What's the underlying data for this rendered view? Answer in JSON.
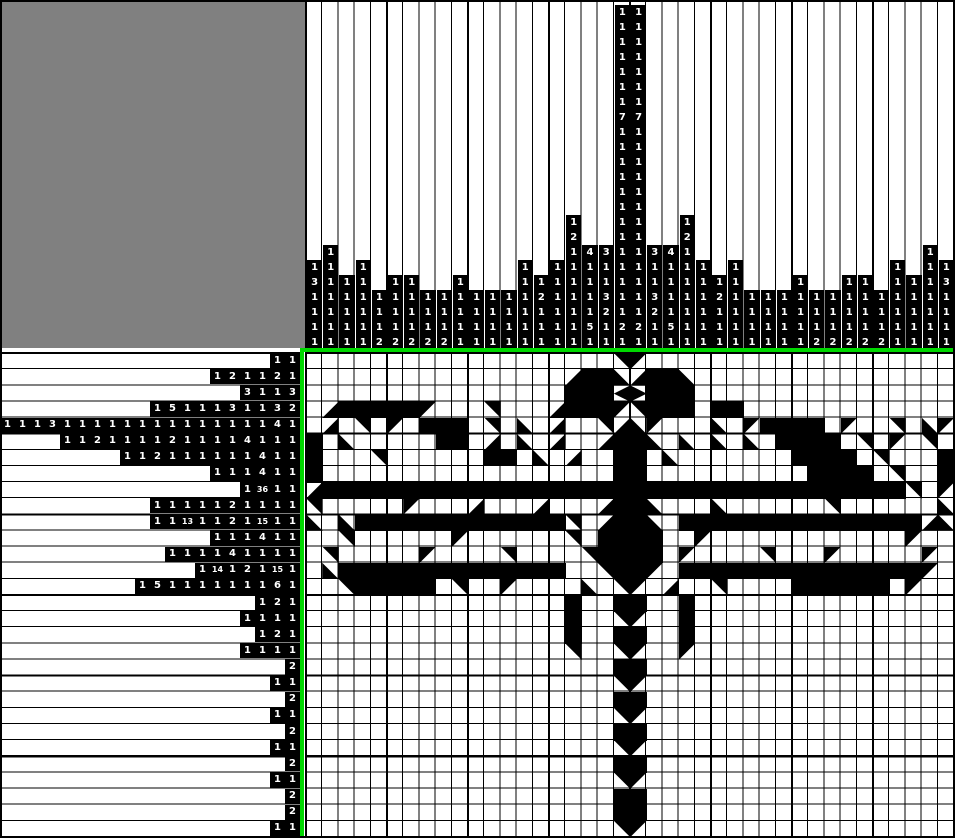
{
  "puzzle_type": "nonogram-triangles",
  "colors": {
    "background": "#ffffff",
    "corner_panel": "#808080",
    "clue_cell_bg": "#000000",
    "clue_text": "#ffffff",
    "grid_lines": "#000000",
    "solution_fill": "#000000",
    "divider_green": "#00d800"
  },
  "layout": {
    "grid_columns": 40,
    "grid_rows": 30,
    "cell_width": 16.2,
    "cell_height": 16.13,
    "thick_line_every": 5,
    "clue_unit": 15,
    "grid_left": 303,
    "grid_top": 350
  },
  "column_clues": [
    [
      1,
      3,
      1,
      1,
      1,
      1
    ],
    [
      1,
      1,
      1,
      1,
      1,
      1,
      1
    ],
    [
      1,
      1,
      1,
      1,
      1
    ],
    [
      1,
      1,
      1,
      1,
      1,
      1
    ],
    [
      1,
      1,
      1,
      2
    ],
    [
      1,
      1,
      1,
      1,
      2
    ],
    [
      1,
      1,
      1,
      1,
      2
    ],
    [
      1,
      1,
      1,
      2
    ],
    [
      1,
      1,
      1,
      2
    ],
    [
      1,
      1,
      1,
      1,
      1
    ],
    [
      1,
      1,
      1,
      1
    ],
    [
      1,
      1,
      1,
      1
    ],
    [
      1,
      1,
      1,
      1
    ],
    [
      1,
      1,
      1,
      1,
      1,
      1
    ],
    [
      1,
      2,
      1,
      1,
      1
    ],
    [
      1,
      1,
      1,
      1,
      1,
      1
    ],
    [
      1,
      2,
      1,
      1,
      1,
      1,
      1,
      1,
      1
    ],
    [
      4,
      1,
      1,
      1,
      1,
      5,
      1
    ],
    [
      3,
      1,
      1,
      3,
      2,
      1,
      1
    ],
    [
      1,
      1,
      1,
      1,
      1,
      1,
      1,
      7,
      1,
      1,
      1,
      1,
      1,
      1,
      1,
      1,
      1,
      1,
      1,
      1,
      1,
      2,
      1
    ],
    [
      1,
      1,
      1,
      1,
      1,
      1,
      1,
      7,
      1,
      1,
      1,
      1,
      1,
      1,
      1,
      1,
      1,
      1,
      1,
      1,
      1,
      2,
      1
    ],
    [
      3,
      1,
      1,
      3,
      2,
      1,
      1
    ],
    [
      4,
      1,
      1,
      1,
      1,
      5,
      1
    ],
    [
      1,
      2,
      1,
      1,
      1,
      1,
      1,
      1,
      1
    ],
    [
      1,
      1,
      1,
      1,
      1,
      1
    ],
    [
      1,
      2,
      1,
      1,
      1
    ],
    [
      1,
      1,
      1,
      1,
      1,
      1
    ],
    [
      1,
      1,
      1,
      1
    ],
    [
      1,
      1,
      1,
      1
    ],
    [
      1,
      1,
      1,
      1
    ],
    [
      1,
      1,
      1,
      1,
      1
    ],
    [
      1,
      1,
      1,
      2
    ],
    [
      1,
      1,
      1,
      2
    ],
    [
      1,
      1,
      1,
      1,
      2
    ],
    [
      1,
      1,
      1,
      1,
      2
    ],
    [
      1,
      1,
      1,
      2
    ],
    [
      1,
      1,
      1,
      1,
      1,
      1
    ],
    [
      1,
      1,
      1,
      1,
      1
    ],
    [
      1,
      1,
      1,
      1,
      1,
      1,
      1
    ],
    [
      1,
      3,
      1,
      1,
      1,
      1
    ]
  ],
  "row_clues": [
    [
      1,
      1
    ],
    [
      1,
      2,
      1,
      1,
      2,
      1
    ],
    [
      3,
      1,
      1,
      3
    ],
    [
      1,
      5,
      1,
      1,
      1,
      3,
      1,
      1,
      3,
      2
    ],
    [
      1,
      1,
      1,
      3,
      1,
      1,
      1,
      1,
      1,
      1,
      1,
      1,
      1,
      1,
      1,
      1,
      1,
      1,
      4,
      1
    ],
    [
      1,
      1,
      2,
      1,
      1,
      1,
      1,
      2,
      1,
      1,
      1,
      1,
      4,
      1,
      1,
      1
    ],
    [
      1,
      1,
      2,
      1,
      1,
      1,
      1,
      1,
      1,
      4,
      1,
      1
    ],
    [
      1,
      1,
      1,
      4,
      1,
      1
    ],
    [
      1,
      36,
      1,
      1
    ],
    [
      1,
      1,
      1,
      1,
      1,
      2,
      1,
      1,
      1,
      1
    ],
    [
      1,
      1,
      13,
      1,
      1,
      2,
      1,
      15,
      1,
      1
    ],
    [
      1,
      1,
      1,
      4,
      1,
      1
    ],
    [
      1,
      1,
      1,
      1,
      4,
      1,
      1,
      1,
      1
    ],
    [
      1,
      14,
      1,
      2,
      1,
      15,
      1
    ],
    [
      1,
      5,
      1,
      1,
      1,
      1,
      1,
      1,
      1,
      6,
      1
    ],
    [
      1,
      2,
      1
    ],
    [
      1,
      1,
      1,
      1
    ],
    [
      1,
      2,
      1
    ],
    [
      1,
      1,
      1,
      1
    ],
    [
      2
    ],
    [
      1,
      1
    ],
    [
      2
    ],
    [
      1,
      1
    ],
    [
      2
    ],
    [
      1,
      1
    ],
    [
      2
    ],
    [
      1,
      1
    ],
    [
      2
    ],
    [
      2
    ],
    [
      1,
      1
    ]
  ],
  "cell_glyphs": {
    ".": "empty",
    "F": "full-square",
    "a": "triangle-nw-icon",
    "b": "triangle-ne-icon",
    "c": "triangle-sw-icon",
    "d": "triangle-se-icon",
    "q": "diamond-left-half-icon",
    "p": "diamond-right-half-icon"
  },
  "solution_rows": [
    "...................ba...................",
    "................dFFcdFFc................",
    "................FFFqpFFF................",
    ".dFFFFFa...b...dFFFabFFF.FF.............",
    ".d.b.a.FFF.b.c.d..bdca...c.aFFFF.a..b.ca",
    "F.c.....FF.d.c.d..dFFc.c.c.c.FFFF.b.a.b.",
    "F...b......FF.c.d..FF.c.......FFFF.b...F",
    "F..................FF..........FFFF.b..F",
    "dFFFFFFFFFFFFFFFFFFFFFFFFFFFFFFFFFFFFb.a",
    "b.....a...d...d...dFFc...c......b......c",
    "c.cFFFFFFFFFFFFFb.dFFc.FFFFFFFFFFFFFFFdc",
    "..b......a......b.FFFF..a............a..",
    ".b.....a....b....bFFFF.a....b...a.....a.",
    ".cFFFFFFFFFFFFFF..bFFa.FFFFFFFFFFFFFFFa.",
    "..bFFFFF.b..a....c.ba.d..b....FFFFFF.a..",
    "................F..FF..F................",
    "................F..ba..F................",
    "................F..FF..F................",
    "................b..ba..a................",
    "...................FF...................",
    "...................ba...................",
    "...................FF...................",
    "...................ba...................",
    "...................FF...................",
    "...................ba...................",
    "...................FF...................",
    "...................ba...................",
    "...................FF...................",
    "...................FF...................",
    "...................ba..................."
  ]
}
